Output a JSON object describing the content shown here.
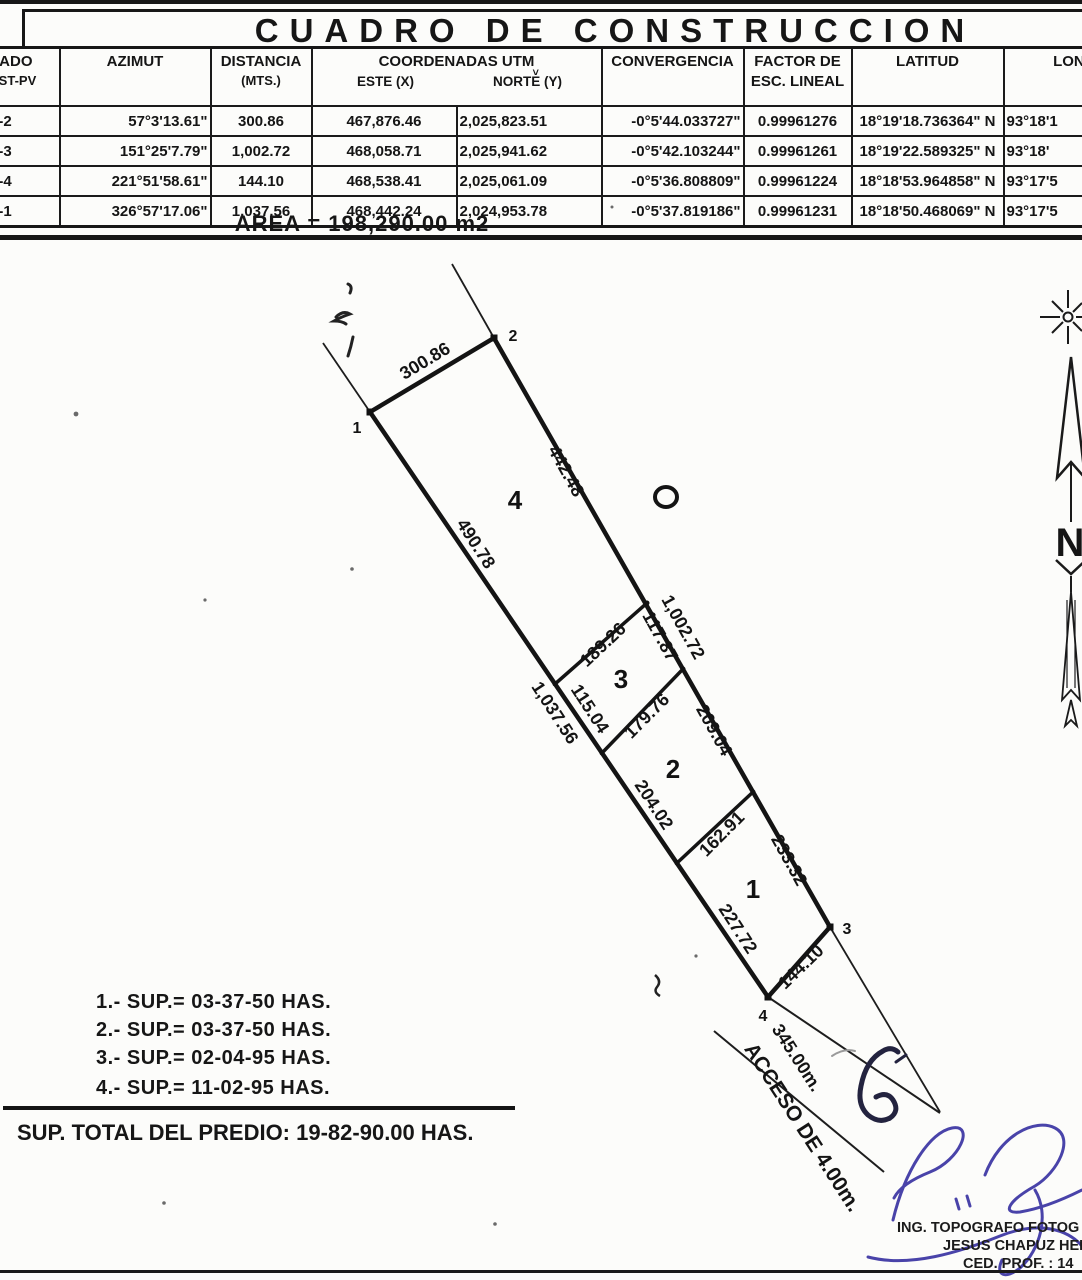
{
  "title": "CUADRO DE CONSTRUCCION",
  "table": {
    "headers": {
      "lado_line1": "LADO",
      "lado_line2": "EST-PV",
      "azimut": "AZIMUT",
      "distancia_line1": "DISTANCIA",
      "distancia_line2": "(MTS.)",
      "coordenadas": "COORDENADAS UTM",
      "caret_mark": "˅",
      "este": "ESTE (X)",
      "norte": "NORTE (Y)",
      "convergencia": "CONVERGENCIA",
      "factor_line1": "FACTOR DE",
      "factor_line2": "ESC. LINEAL",
      "latitud": "LATITUD",
      "longitud": "LONGITUD"
    },
    "rows": [
      {
        "lado": "1-2",
        "azimut": "57°3'13.61\"",
        "distancia": "300.86",
        "este": "467,876.46",
        "norte": "2,025,823.51",
        "convergencia": "-0°5'44.033727\"",
        "factor": "0.99961276",
        "latitud": "18°19'18.736364\" N",
        "longitud": "93°18'1"
      },
      {
        "lado": "2-3",
        "azimut": "151°25'7.79\"",
        "distancia": "1,002.72",
        "este": "468,058.71",
        "norte": "2,025,941.62",
        "convergencia": "-0°5'42.103244\"",
        "factor": "0.99961261",
        "latitud": "18°19'22.589325\" N",
        "longitud": "93°18'"
      },
      {
        "lado": "3-4",
        "azimut": "221°51'58.61\"",
        "distancia": "144.10",
        "este": "468,538.41",
        "norte": "2,025,061.09",
        "convergencia": "-0°5'36.808809\"",
        "factor": "0.99961224",
        "latitud": "18°18'53.964858\" N",
        "longitud": "93°17'5"
      },
      {
        "lado": "4-1",
        "azimut": "326°57'17.06\"",
        "distancia": "1,037.56",
        "este": "468,442.24",
        "norte": "2,024,953.78",
        "convergencia": "-0°5'37.819186\"",
        "factor": "0.99961231",
        "latitud": "18°18'50.468069\" N",
        "longitud": "93°17'5"
      }
    ],
    "area_label": "AREA = 198,290.00 m2"
  },
  "drawing": {
    "measurements": {
      "top": "300.86",
      "lot4_right": "442.48",
      "lot4_left": "490.78",
      "right_total": "1,002.72",
      "lot3_right": "117.87",
      "divider_4_3": "189.26",
      "lot3_left": "115.04",
      "left_total": "1,037.56",
      "divider_3_2": "179.76",
      "lot2_right": "209.04",
      "lot2_left": "204.02",
      "divider_2_1": "162.91",
      "lot1_right": "233.32",
      "lot1_left": "227.72",
      "bottom": "144.10",
      "road_length": "345.00m.",
      "road_name": "ACCESO DE 4.00m."
    },
    "lots": {
      "lot1": "1",
      "lot2": "2",
      "lot3": "3",
      "lot4": "4"
    },
    "vertices": {
      "v1": "1",
      "v2": "2",
      "v3": "3",
      "v4": "4"
    },
    "north_letter": "N"
  },
  "summary": {
    "lines": [
      "1.- SUP.= 03-37-50 HAS.",
      "2.- SUP.= 03-37-50 HAS.",
      "3.- SUP.= 02-04-95 HAS.",
      "4.- SUP.= 11-02-95 HAS."
    ],
    "total": "SUP. TOTAL DEL PREDIO: 19-82-90.00 HAS."
  },
  "credentials": {
    "line1": "ING. TOPOGRAFO FOTOG",
    "line2": "JESUS CHAPUZ HER",
    "line3": "CED. PROF. : 14"
  },
  "colors": {
    "ink": "#161616",
    "signature_blue": "#3a34a3",
    "scribble_dark": "#23233f"
  }
}
